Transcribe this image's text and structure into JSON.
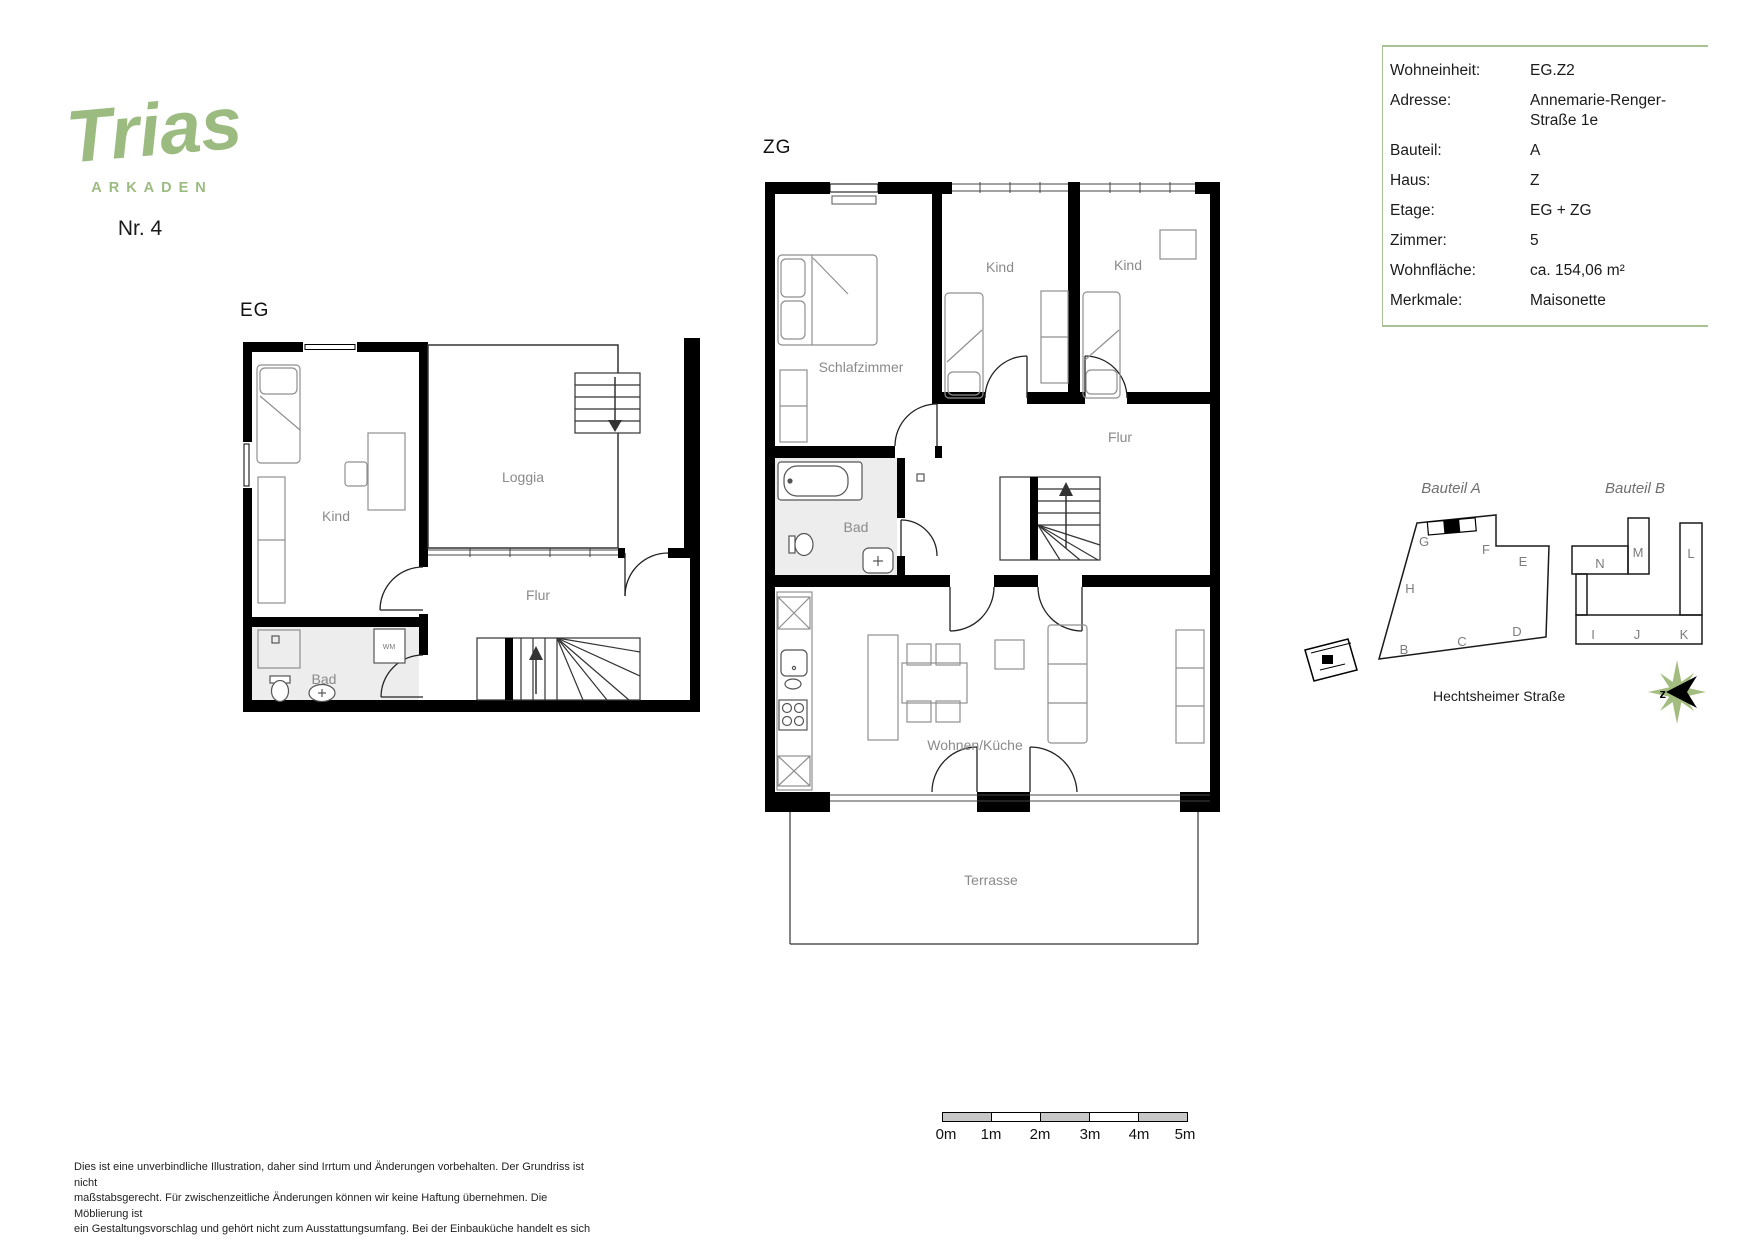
{
  "logo": {
    "brand": "Trias",
    "sub": "ARKADEN",
    "unit_no": "Nr. 4"
  },
  "info_table": {
    "rows": [
      {
        "label": "Wohneinheit:",
        "value": "EG.Z2"
      },
      {
        "label": "Adresse:",
        "value": "Annemarie-Renger-",
        "value2": "Straße 1e"
      },
      {
        "label": "Bauteil:",
        "value": "A"
      },
      {
        "label": "Haus:",
        "value": "Z"
      },
      {
        "label": "Etage:",
        "value": "EG + ZG"
      },
      {
        "label": "Zimmer:",
        "value": "5"
      },
      {
        "label": "Wohnfläche:",
        "value": "ca. 154,06 m²"
      },
      {
        "label": "Merkmale:",
        "value": "Maisonette"
      }
    ]
  },
  "eg": {
    "title": "EG",
    "rooms": {
      "kind": "Kind",
      "loggia": "Loggia",
      "flur": "Flur",
      "bad": "Bad"
    },
    "labels": {
      "wm": "WM"
    }
  },
  "zg": {
    "title": "ZG",
    "rooms": {
      "schlafzimmer": "Schlafzimmer",
      "kind1": "Kind",
      "kind2": "Kind",
      "flur": "Flur",
      "bad": "Bad",
      "wohnen": "Wohnen/Küche",
      "terrasse": "Terrasse"
    }
  },
  "site": {
    "bauteil_a": {
      "title": "Bauteil A",
      "letters": [
        "G",
        "F",
        "E",
        "H",
        "B",
        "C",
        "D"
      ]
    },
    "bauteil_b": {
      "title": "Bauteil B",
      "letters": [
        "N",
        "M",
        "L",
        "I",
        "J",
        "K"
      ]
    },
    "street": "Hechtsheimer Straße",
    "compass_label": "z"
  },
  "scale_bar": {
    "labels": [
      "0m",
      "1m",
      "2m",
      "3m",
      "4m",
      "5m"
    ]
  },
  "disclaimer": {
    "lines": [
      "Dies ist eine unverbindliche Illustration, daher sind Irrtum und Änderungen vorbehalten. Der Grundriss ist nicht",
      "maßstabsgerecht. Für zwischenzeitliche Änderungen können wir keine Haftung übernehmen. Die Möblierung ist",
      "ein Gestaltungsvorschlag und gehört nicht zum Ausstattungsumfang. Bei der Einbauküche handelt es sich um eine",
      "unverbindliche Darstellung. Die Einbauküche kann hiervon in der Realität abweichen."
    ]
  },
  "colors": {
    "brand_green": "#9cbb81",
    "rule_green": "#a9c295",
    "wall_black": "#000000",
    "label_gray": "#8a8a8a",
    "bath_gray": "#ededed",
    "scale_gray": "#c7c7c7",
    "compass_green": "#a3bd81"
  }
}
